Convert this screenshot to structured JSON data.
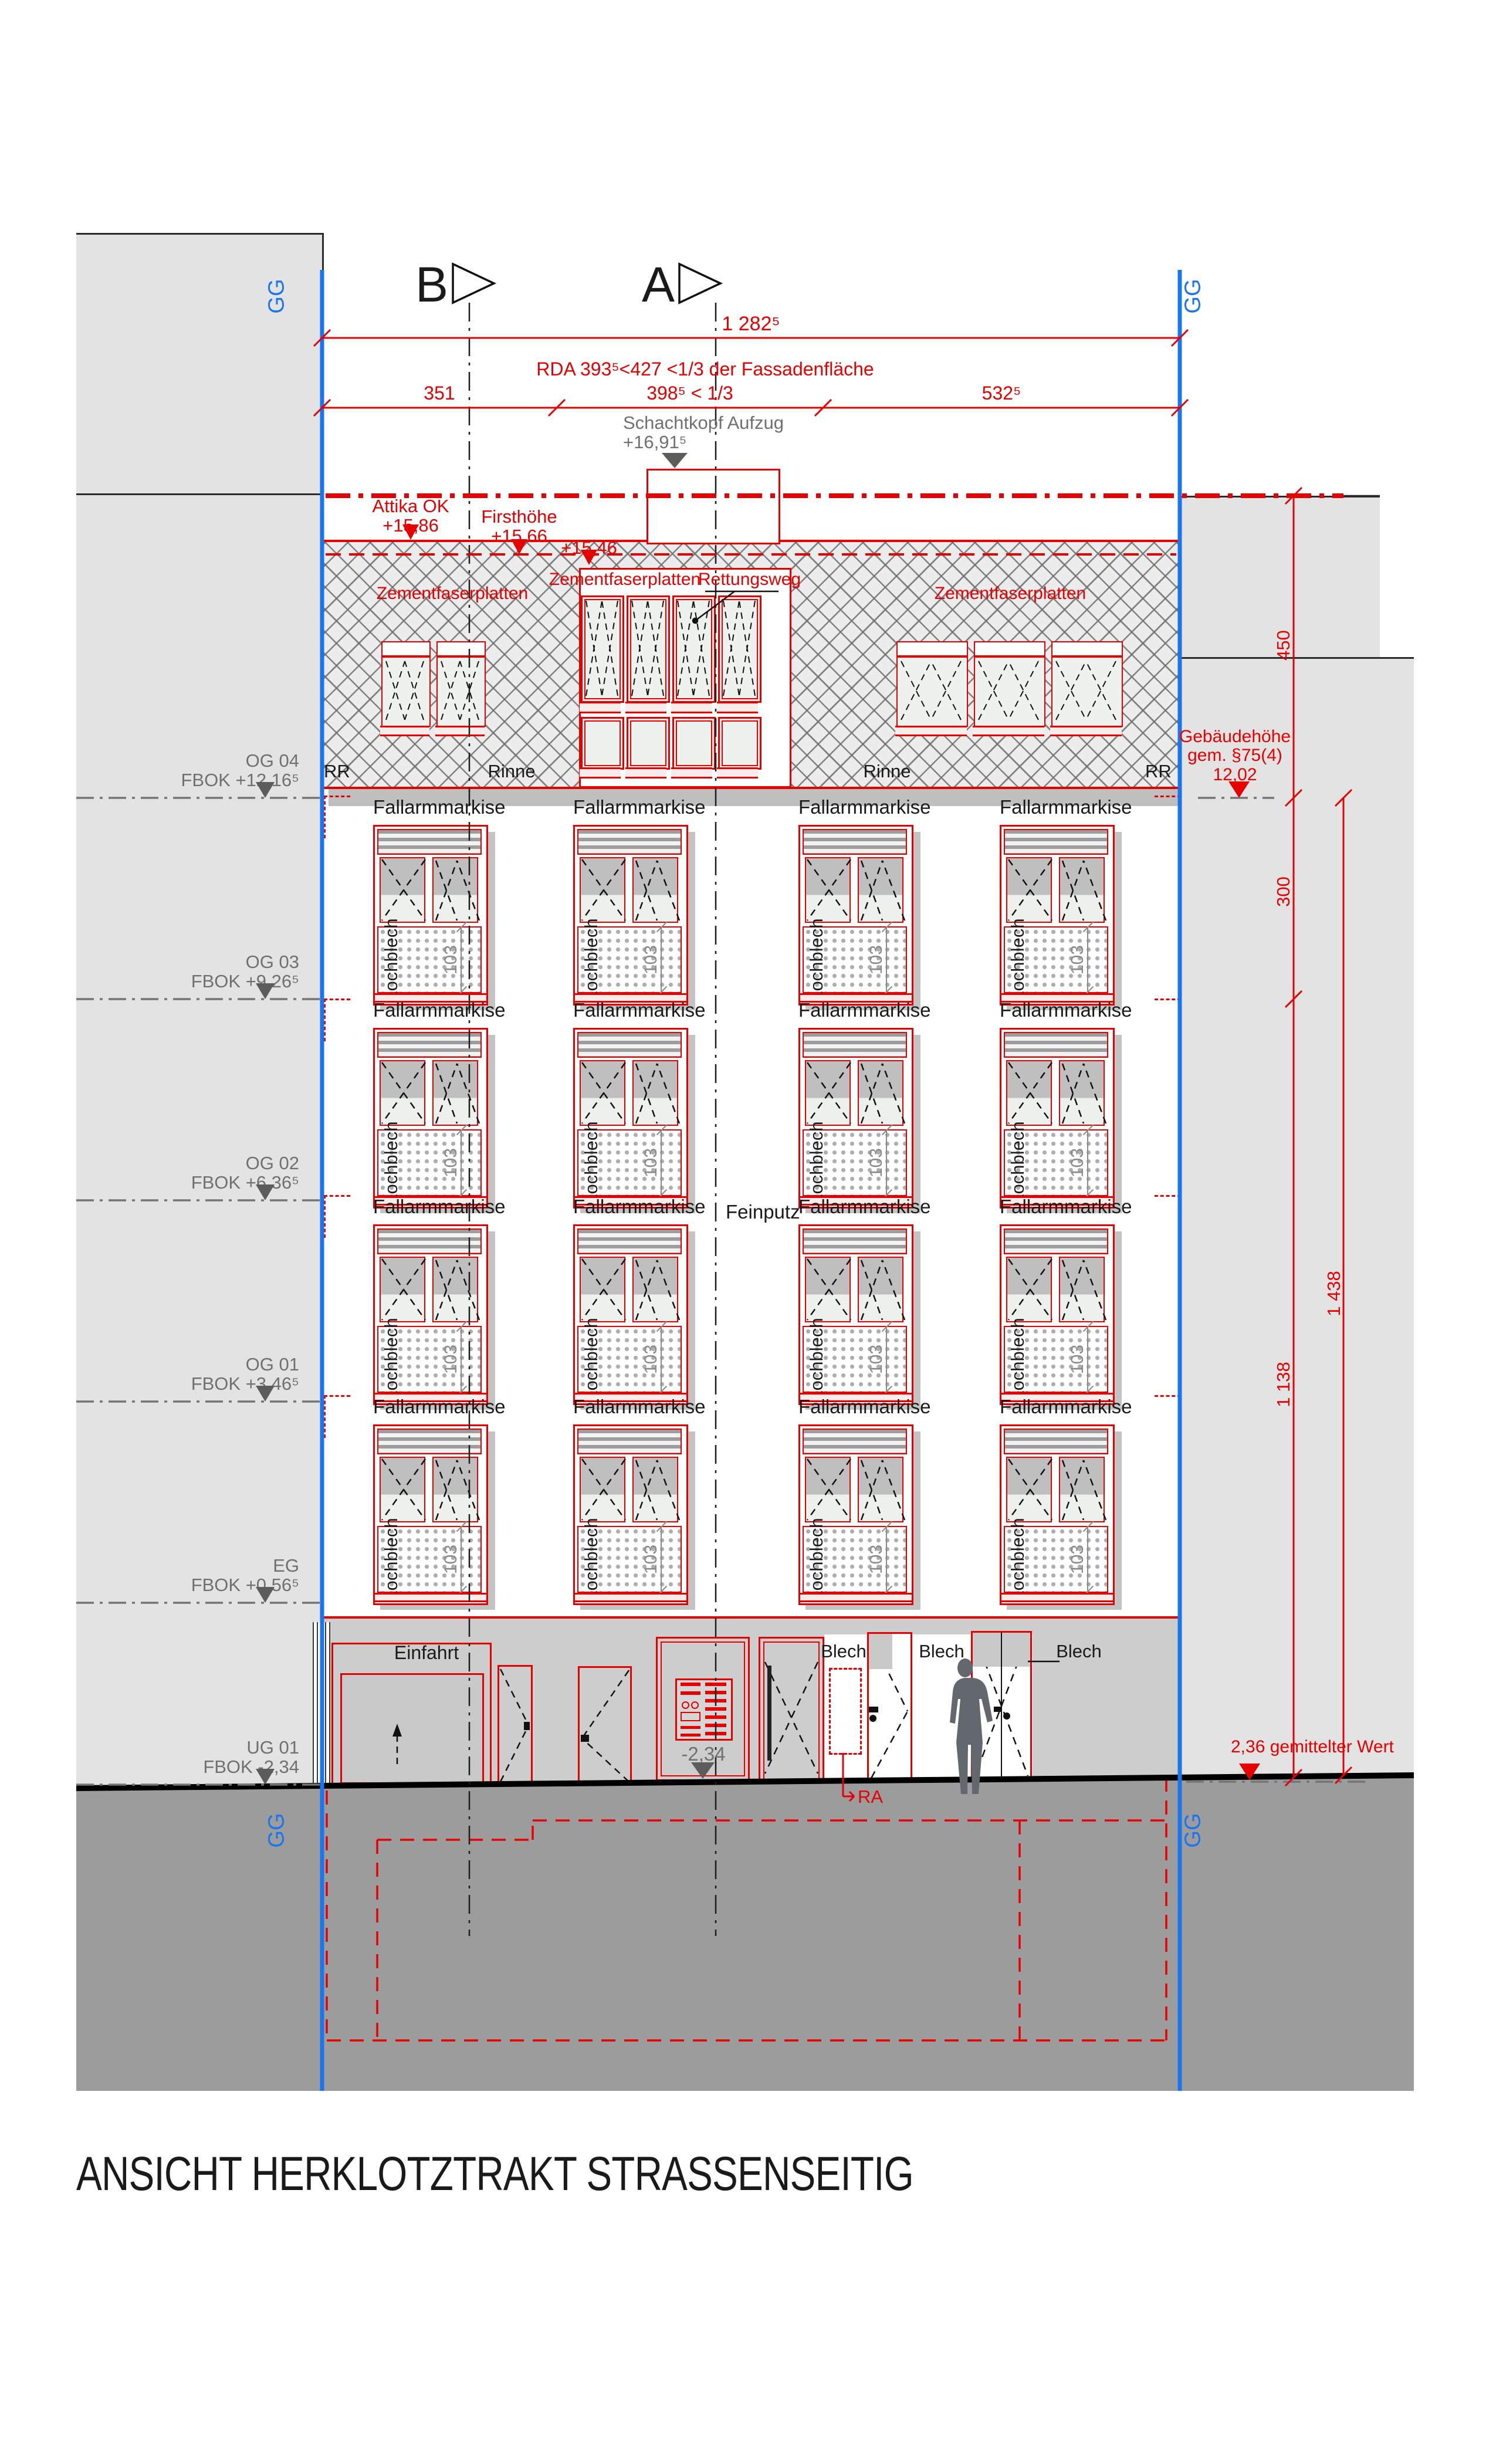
{
  "title": "ANSICHT HERKLOTZTRAKT STRASSENSEITIG",
  "grid_label": "GG",
  "sections": {
    "b": "B",
    "a": "A"
  },
  "top_dims": {
    "total": "1 282⁵",
    "rda_note": "RDA 393⁵<427 <1/3 der Fassadenfläche",
    "seg_left": "351",
    "seg_mid": "398⁵ < 1/3",
    "seg_right": "532⁵"
  },
  "shaft_head": {
    "label": "Schachtkopf Aufzug\n+16,91⁵"
  },
  "roof_levels": {
    "attika": "Attika OK\n+15,86",
    "ridge": "Firsthöhe\n+15,66",
    "eave": "+15,46"
  },
  "roof": {
    "cladding_left": "Zementfaserplatten",
    "cladding_center": "Zementfaserplatten",
    "cladding_right": "Zementfaserplatten",
    "rescue_route": "Rettungsweg",
    "rr_left": "RR",
    "rr_right": "RR",
    "gutter_left": "Rinne",
    "gutter_right": "Rinne"
  },
  "facade": {
    "awning": "Fallarmmarkise",
    "perforated_sheet": "Lochblech",
    "window_dim": "103",
    "plaster": "Feinputz"
  },
  "floors": [
    {
      "name": "OG 04",
      "level": "FBOK +12,16⁵"
    },
    {
      "name": "OG 03",
      "level": "FBOK +9,26⁵"
    },
    {
      "name": "OG 02",
      "level": "FBOK +6,36⁵"
    },
    {
      "name": "OG 01",
      "level": "FBOK +3,46⁵"
    },
    {
      "name": "EG",
      "level": "FBOK +0,56⁵"
    },
    {
      "name": "UG 01",
      "level": "FBOK -2,34"
    }
  ],
  "right_dims": {
    "building_height": "Gebäudehöhe\ngem. §75(4)\n12,02",
    "d450": "450",
    "d300": "300",
    "d1138": "1 138",
    "d1438": "1 438",
    "ground_note": "2,36 gemittelter Wert"
  },
  "ground_floor": {
    "entry": "Einfahrt",
    "level": "-2,34",
    "blech": [
      "Blech",
      "Blech",
      "Blech"
    ],
    "ra": "RA"
  },
  "colors": {
    "accent_red": "#e60000",
    "grid_blue": "#1a75f0",
    "gray_text": "#707070"
  }
}
